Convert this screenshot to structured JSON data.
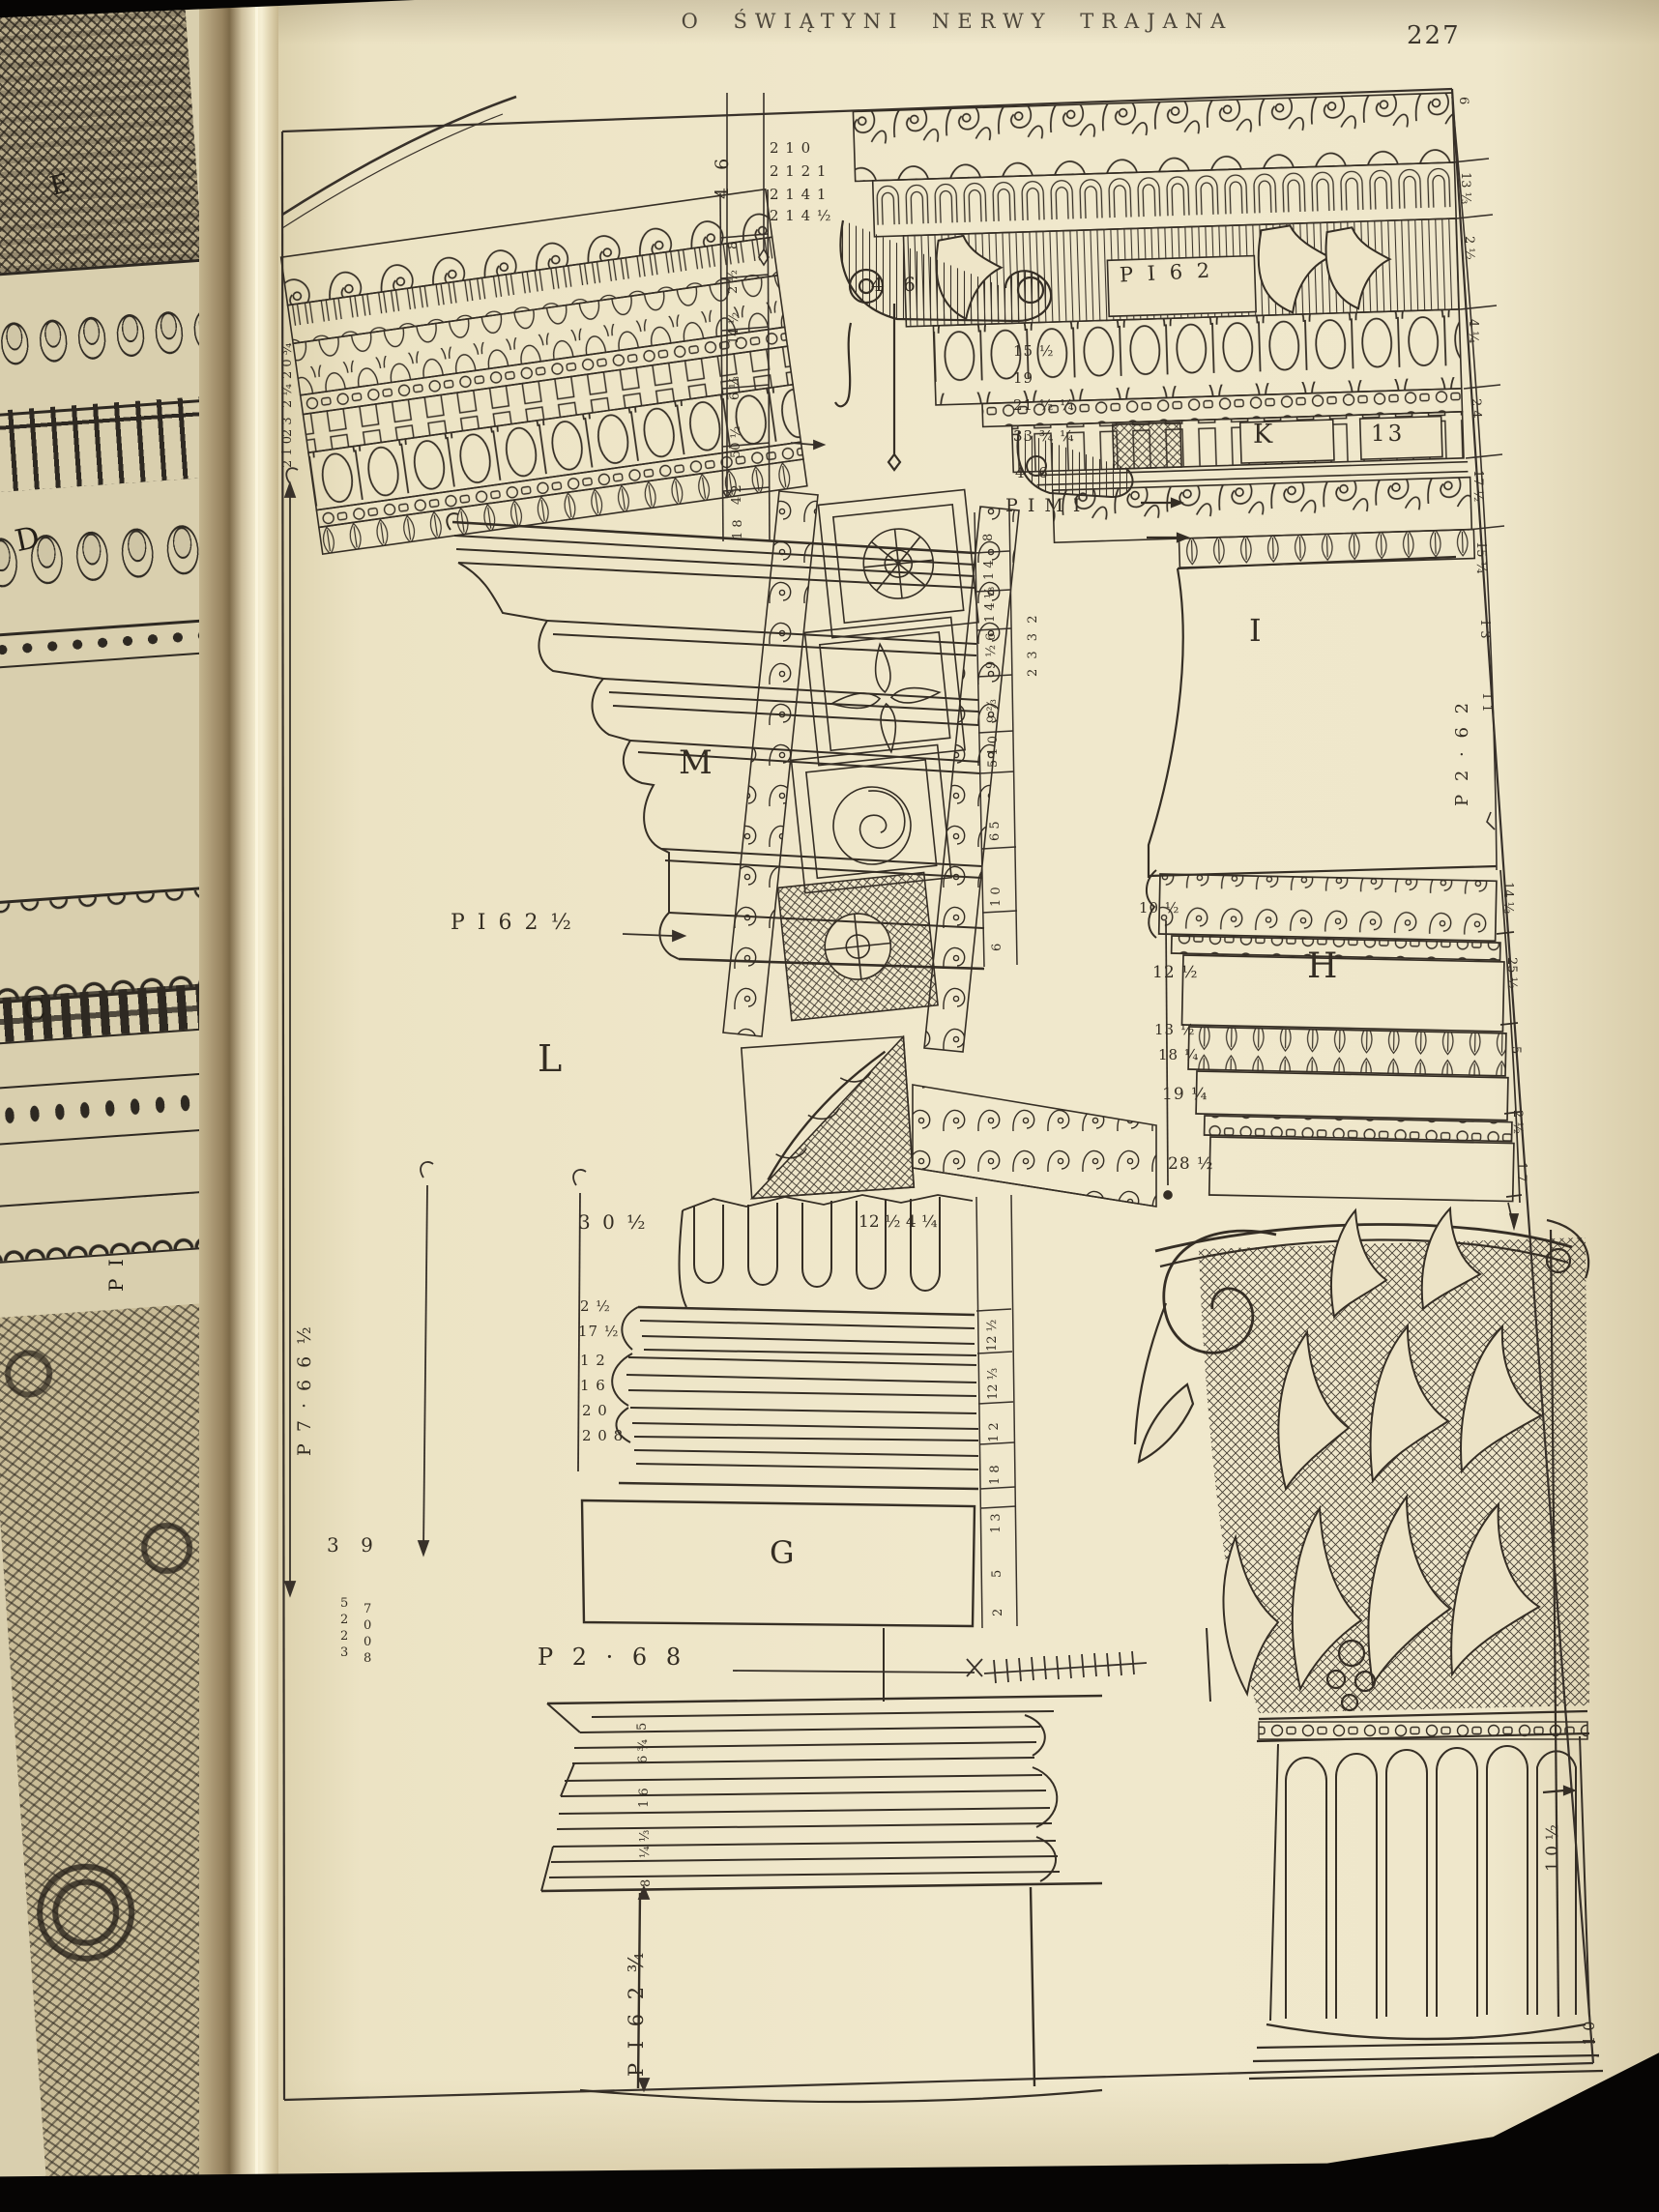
{
  "photo": {
    "header_title": "O ŚWIĄTYNI NERWY TRAJANA",
    "page_number": "227"
  },
  "left_page": {
    "label_e": "E",
    "label_d": "D",
    "label_c": "C",
    "label_pi": "P I"
  },
  "plate": {
    "sections": {
      "m": "M",
      "l": "L",
      "g": "G",
      "i": "I",
      "h": "H",
      "k": "K",
      "panel_13": "13"
    },
    "dims": {
      "pi62": "P I 6 2",
      "pimi": "P I M I",
      "top46_v": "4 6",
      "top46_h": "4 6",
      "pi62_half": "P I 6 2 ½",
      "p268": "P 2 · 6 8",
      "p766_half": "P 7 · 6 6 ½",
      "pi62_34": "P I 6 2 ¾",
      "p262": "P 2 · 6 2",
      "flute_top": "12 ½ 4 ¼",
      "base_30": "3 0 ½",
      "n39": "3 9",
      "cap_10": "1 0 ½",
      "corner_10": "1 0"
    },
    "columns": {
      "top_left": [
        "2 1 0",
        "2 1 2 1",
        "2 1 4 1",
        "2 1 4 ½"
      ],
      "k_left": [
        "15 ½",
        "19",
        "21 ½ ¼",
        "33 ¾ ¼",
        "4 6"
      ],
      "left_border": [
        "2 0 ¾",
        "2 ¼",
        "2 3",
        "2 1 0"
      ],
      "left_cornice_ruler": [
        "8",
        "2 ½",
        "14 ½",
        "6 ⅓",
        "50 ½",
        "4 2",
        "1 8"
      ],
      "m_ruler": [
        "8",
        "1 4",
        "1 4 ⅓",
        "9 ½ 6",
        "9 ⅔",
        "5 1 0",
        "6 5",
        "1 0",
        "6"
      ],
      "top_right_ruler": [
        "6",
        "13 ⅓",
        "2 ½",
        "4 ¼",
        "2 4",
        "17 ½",
        "15 ¼",
        "1 3",
        "1 1"
      ],
      "coffer_ruler": "2 3 3 2",
      "h_left": [
        "10 ½",
        "12 ½",
        "13 ½",
        "18 ¼",
        "19 ¼",
        "28 ½"
      ],
      "h_right_ruler": [
        "14 ⅓",
        "25 ½",
        "5",
        "2 ½",
        "1 7"
      ],
      "base_left": [
        "2 ½",
        "17 ½",
        "1 2",
        "1 6",
        "2 0",
        "2 0 8"
      ],
      "base_right_ruler": [
        "12 ½",
        "12 ⅓",
        "1 2",
        "1 8",
        "1 3",
        "5",
        "2"
      ],
      "plinth_ticks": [
        "5",
        "6 ¾",
        "1 6",
        "¼ ⅓",
        "8"
      ],
      "stack_a": [
        "5",
        "2",
        "2",
        "3"
      ],
      "stack_b": [
        "7",
        "0",
        "0",
        "8"
      ]
    }
  }
}
